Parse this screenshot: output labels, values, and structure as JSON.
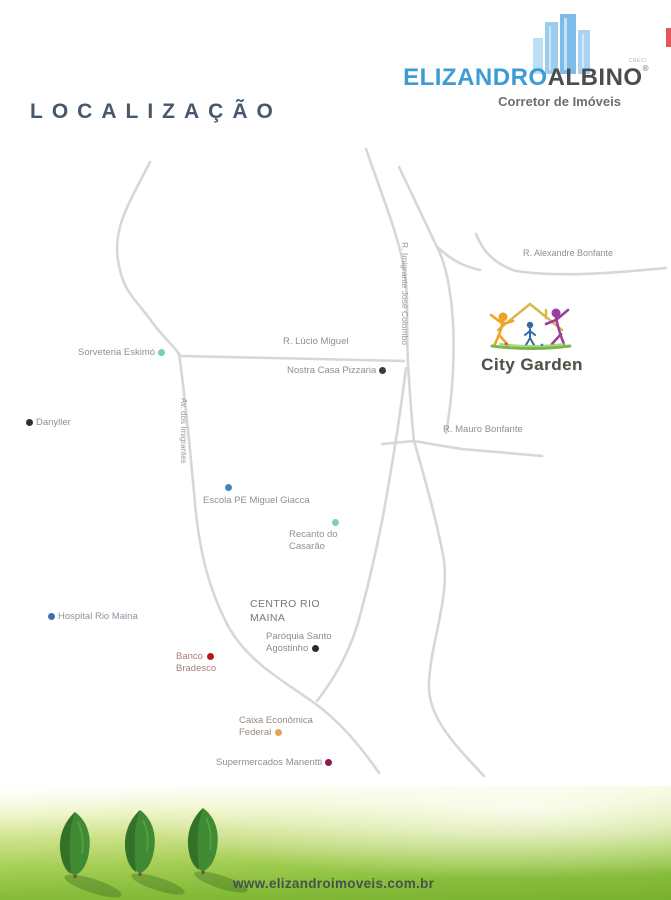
{
  "header": {
    "brand_part1": "ELIZANDRO",
    "brand_part2": "ALBINO",
    "registered_mark": "®",
    "creci": "CRECI",
    "tagline": "Corretor de Imóveis",
    "brand_blue": "#3d9bd5",
    "brand_dark": "#4a4c4f"
  },
  "title": "LOCALIZAÇÃO",
  "map": {
    "roads": {
      "alexandre": "R. Alexandre Bonfante",
      "lucio": "R. Lúcio Miguel",
      "imigrante_colombo": "R. Imigrante José Colombo",
      "mauro": "R. Mauro Bonfante",
      "av_imigrantes": "Av. dos Imigrantes"
    },
    "district": {
      "line1": "CENTRO RIO",
      "line2": "MAINA"
    },
    "road_color": "#d7d7d7",
    "pois": {
      "sorveteria": {
        "label": "Sorveteria Eskimó",
        "dot": "#6ecfc4"
      },
      "pizzaria": {
        "label": "Nostra Casa Pizzaria",
        "dot": "#3a3a3a"
      },
      "danyller": {
        "label": "Danyller",
        "dot": "#2f2f2f"
      },
      "escola": {
        "label": "Escola PE Miguel Giacca",
        "dot": "#3f87c2"
      },
      "recanto": {
        "line1": "Recanto do",
        "line2": "Casarão",
        "dot": "#7fccc2"
      },
      "hospital": {
        "label": "Hospital Rio Maina",
        "dot": "#3f6fae"
      },
      "paroquia": {
        "line1": "Paróquia Santo",
        "line2": "Agostinho",
        "dot": "#2e2a28"
      },
      "banco": {
        "line1": "Banco",
        "line2": "Bradesco",
        "dot": "#b3181f"
      },
      "caixa": {
        "line1": "Caixa Econômica",
        "line2": "Federal",
        "dot": "#e3a45a"
      },
      "supermercado": {
        "label": "Supermercados Manentti",
        "dot": "#8d1a4e"
      }
    },
    "development": {
      "name": "City Garden"
    }
  },
  "footer": {
    "url": "www.elizandroimoveis.com.br"
  }
}
